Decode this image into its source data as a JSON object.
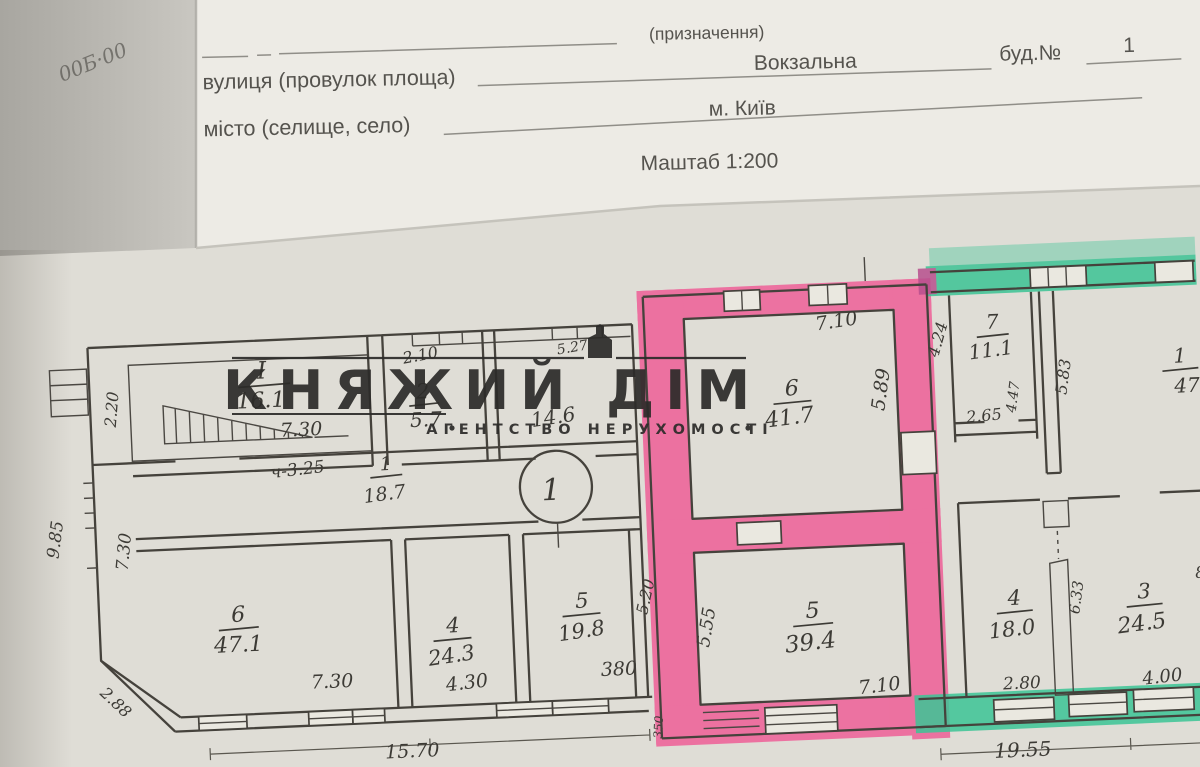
{
  "photo": {
    "corner_scribble": "00Б·00"
  },
  "header": {
    "designation_label": "(призначення)",
    "street_label": "вулиця (провулок площа)",
    "street_value": "Вокзальна",
    "building_label": "буд.№",
    "building_number": "1",
    "city_label": "місто (селище, село)",
    "city_value": "м. Київ",
    "scale_label": "Маштаб 1:200"
  },
  "watermark": {
    "title": "КНЯЖИЙ ДІМ",
    "subtitle": "АГЕНТСТВО НЕРУХОМОСТІ"
  },
  "plan": {
    "entry_mark": "1",
    "left_building": {
      "room_I": {
        "num": "I",
        "area": "16.1"
      },
      "room_2": {
        "num": "2",
        "area": "5.7"
      },
      "room_mid_area": "14.6",
      "corridor": {
        "num": "1",
        "area": "18.7",
        "height_note": "ч-3.25"
      },
      "room_6": {
        "num": "6",
        "area": "47.1"
      },
      "room_4": {
        "num": "4",
        "area": "24.3"
      },
      "room_5": {
        "num": "5",
        "area": "19.8"
      },
      "dims": {
        "room_I_width": "7.30",
        "room_I_depth": "2.20",
        "room_2_width": "2.10",
        "room_mid_width": "5.27",
        "left_height_a": "9.85",
        "left_height_b": "7.30",
        "chamfer": "2.88",
        "room_6_width": "7.30",
        "room_4_width": "4.30",
        "room_5_width": "380",
        "total_width": "15.70"
      }
    },
    "pink_unit": {
      "highlight_color": "#ef5a95",
      "room_6": {
        "num": "6",
        "area": "41.7"
      },
      "room_5": {
        "num": "5",
        "area": "39.4"
      },
      "dims": {
        "room_6_width": "7.10",
        "room_6_depth": "5.89",
        "room_5_depth": "5.55",
        "room_5_width": "7.10",
        "side_height": "5.20",
        "wall_note": "350"
      }
    },
    "right_building": {
      "highlight_color": "#3cc495",
      "room_7": {
        "num": "7",
        "area": "11.1"
      },
      "room_1": {
        "num": "1",
        "area": "47"
      },
      "room_4": {
        "num": "4",
        "area": "18.0"
      },
      "room_3": {
        "num": "3",
        "area": "24.5"
      },
      "dims": {
        "room_7_depth": "4.24",
        "room_7_width": "2.65",
        "duct_height": "4.47",
        "wall_height": "5.83",
        "pier_height": "6.33",
        "room_4_width": "2.80",
        "room_3_width": "4.00",
        "total_width": "19.55",
        "edge_partial": "8"
      }
    }
  }
}
